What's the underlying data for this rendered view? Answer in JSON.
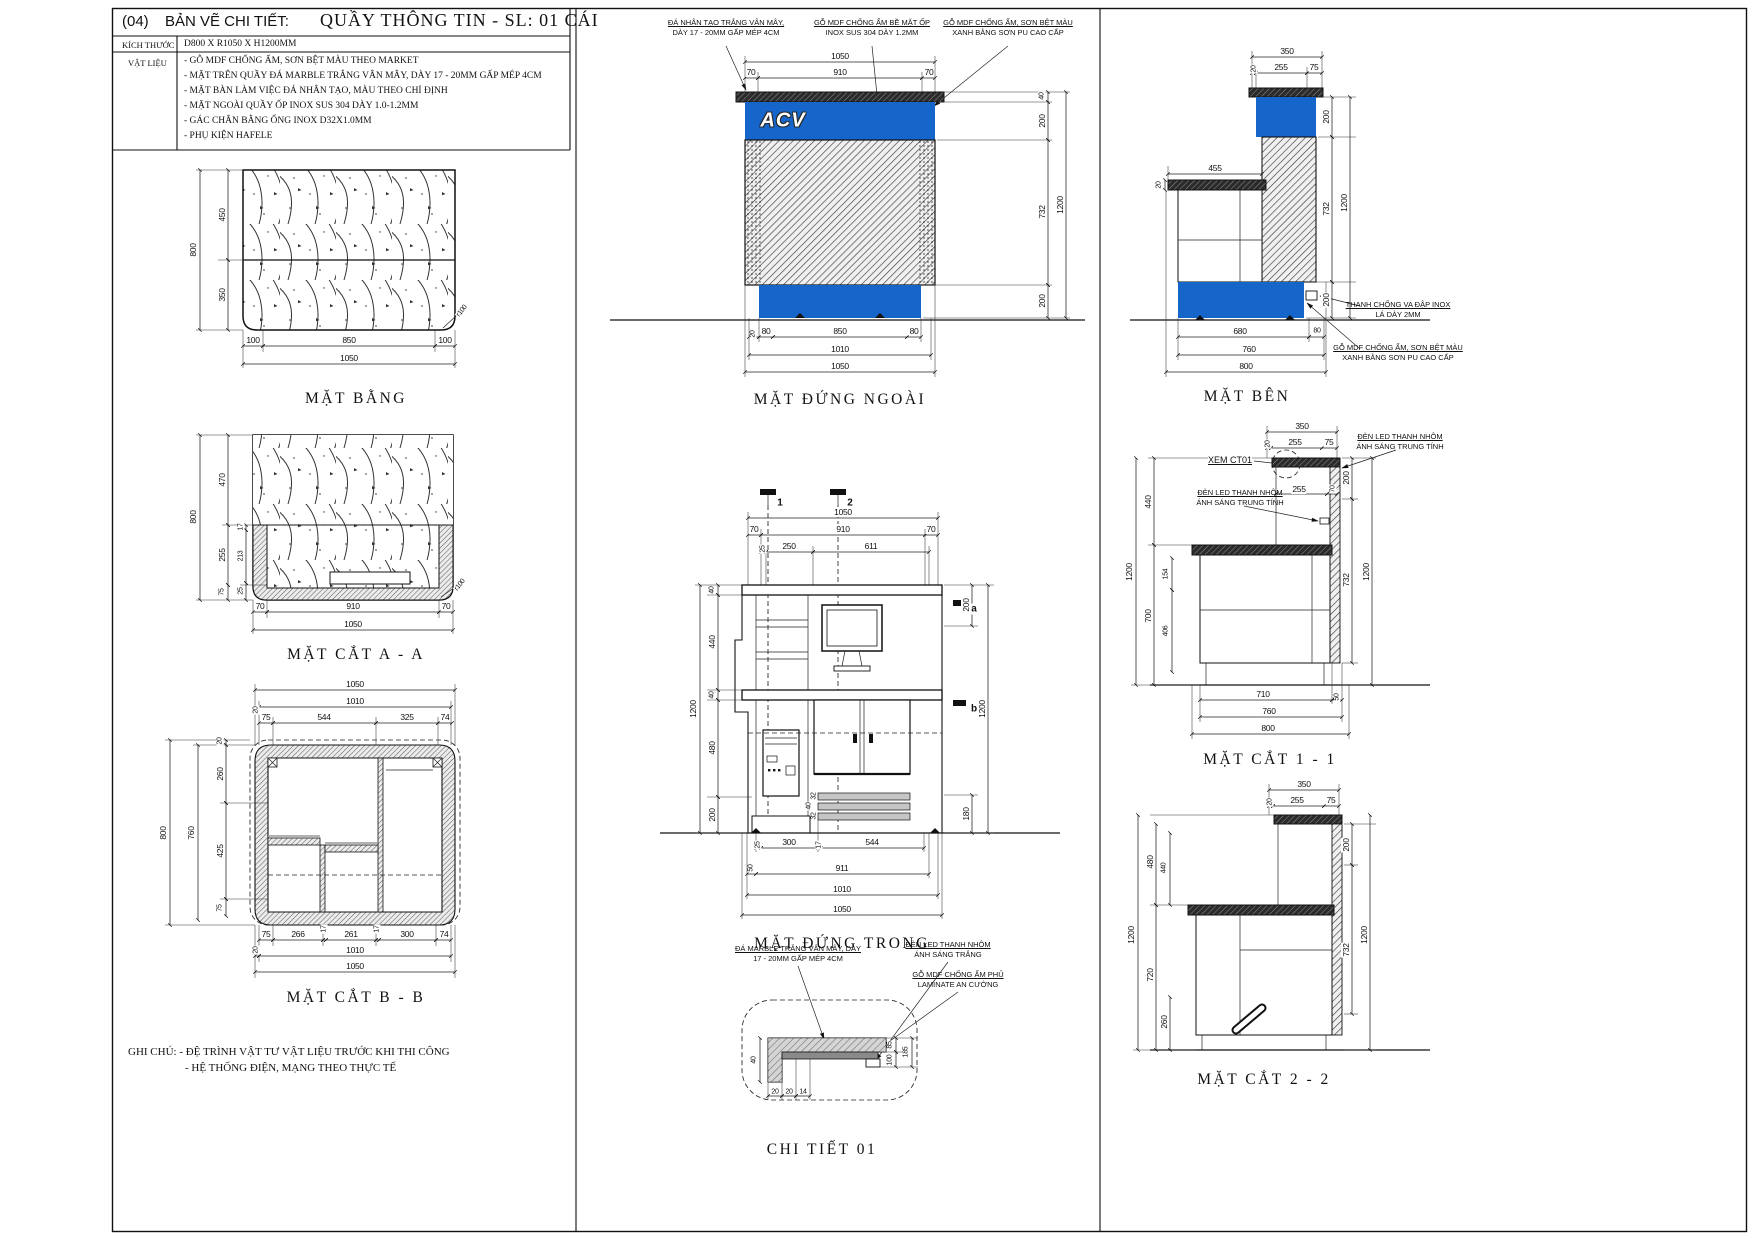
{
  "colors": {
    "accent_blue": "#1565cb",
    "line": "#111111"
  },
  "title_block": {
    "index": "(04)",
    "type_label": "BẢN VẼ CHI TIẾT:",
    "title": "QUẦY THÔNG TIN - SL: 01 CÁI",
    "size_label": "KÍCH THƯỚC",
    "size_value": "D800 X R1050 X H1200MM",
    "material_label": "VẬT LIỆU",
    "materials": [
      "- GỖ MDF CHỐNG ẨM, SƠN BỆT MÀU THEO MARKET",
      "- MẶT TRÊN QUẦY ĐÁ MARBLE TRẮNG VÂN MÂY, DÀY 17 - 20MM GẤP MÉP 4CM",
      "- MẶT BÀN LÀM VIỆC ĐÁ NHÂN TẠO, MÀU THEO CHỈ ĐỊNH",
      "- MẶT NGOÀI QUẦY ỐP INOX SUS 304 DÀY 1.0-1.2MM",
      "- GÁC CHÂN BẰNG ỐNG INOX D32X1.0MM",
      "- PHỤ KIỆN HAFELE"
    ]
  },
  "logo": {
    "text": "ACV"
  },
  "notes": {
    "line1": "GHI CHÚ: - ĐỆ TRÌNH VẬT TƯ VẬT LIỆU TRƯỚC KHI THI CÔNG",
    "line2": "- HỆ THỐNG ĐIỆN, MẠNG THEO THỰC TẾ"
  },
  "views": {
    "mat_bang": {
      "label": "MẶT BẰNG",
      "dims": {
        "w800": "800",
        "h450": "450",
        "h350": "350",
        "b100l": "100",
        "b850": "850",
        "b100r": "100",
        "b1050": "1050",
        "r": "r100"
      }
    },
    "mat_cat_aa": {
      "label": "MẶT CẮT A - A",
      "dims": {
        "l800": "800",
        "l470": "470",
        "l255": "255",
        "l75": "75",
        "i17": "17",
        "i213": "213",
        "i25": "25",
        "b70l": "70",
        "b910": "910",
        "b70r": "70",
        "b1050": "1050",
        "r": "r100"
      }
    },
    "mat_cat_bb": {
      "label": "MẶT CẮT B - B",
      "dims": {
        "t1050": "1050",
        "t1010": "1010",
        "t20": "20",
        "s75": "75",
        "s544": "544",
        "s325": "325",
        "s74": "74",
        "l800": "800",
        "l760": "760",
        "l20": "20",
        "l260": "260",
        "l425": "425",
        "l75": "75",
        "b75": "75",
        "b266": "266",
        "b17a": "17",
        "b261": "261",
        "b17b": "17",
        "b300": "300",
        "b74": "74",
        "b20": "20",
        "b1010": "1010",
        "b1050": "1050"
      }
    },
    "mat_dung_ngoai": {
      "label": "MẶT ĐỨNG NGOÀI",
      "callouts": {
        "stone1": "ĐÁ NHÂN TẠO TRẮNG VÂN MÂY,",
        "stone2": "DÀY 17 - 20MM GẤP MÉP 4CM",
        "inox1": "GỖ MDF CHỐNG ẨM BỀ MẶT ỐP",
        "inox2": "INOX SUS 304 DÀY 1.2MM",
        "mdf1": "GỖ MDF CHỐNG ẨM, SƠN BỆT MÀU",
        "mdf2": "XANH BẰNG SƠN PU CAO CẤP"
      },
      "dims": {
        "t1050": "1050",
        "t70l": "70",
        "t910": "910",
        "t70r": "70",
        "r40": "40",
        "r200t": "200",
        "r732": "732",
        "r200b": "200",
        "r1200": "1200",
        "b20": "20",
        "b80l": "80",
        "b850": "850",
        "b80r": "80",
        "b1010": "1010",
        "b1050": "1050"
      }
    },
    "mat_dung_trong": {
      "label": "MẶT ĐỨNG TRONG",
      "markers": {
        "s1": "1",
        "s2": "2",
        "a": "a",
        "b": "b"
      },
      "dims": {
        "t1050": "1050",
        "t70l": "70",
        "t910": "910",
        "t70r": "70",
        "s25": "25",
        "s250": "250",
        "s611": "611",
        "l1200": "1200",
        "l40t": "40",
        "l440": "440",
        "l40m": "40",
        "l480": "480",
        "l200": "200",
        "r200": "200",
        "r180": "180",
        "r1200": "1200",
        "f32a": "32",
        "f40": "40",
        "f32b": "32",
        "b25": "25",
        "b300": "300",
        "b17": "17",
        "b544": "544",
        "b50": "50",
        "b911": "911",
        "b1010": "1010",
        "b1050": "1050"
      }
    },
    "chi_tiet_01": {
      "label": "CHI TIẾT 01",
      "callouts": {
        "stone1": "ĐÁ MARBLE TRẮNG VÂN MÂY, DÀY",
        "stone2": "17 - 20MM GẤP MÉP 4CM",
        "led1": "ĐÈN LED THANH NHÔM",
        "led2": "ÁNH SÁNG TRẮNG",
        "mdf1": "GỖ MDF CHỐNG ẨM PHỦ",
        "mdf2": "LAMINATE AN CƯỜNG"
      },
      "dims": {
        "v40": "40",
        "b20a": "20",
        "b20b": "20",
        "b14": "14",
        "r85": "85",
        "r100": "100",
        "r185": "185"
      }
    },
    "mat_ben": {
      "label": "MẶT BÊN",
      "callouts": {
        "inox1": "THANH CHỐNG VA ĐẬP INOX",
        "inox2": "LÁ DÀY 2MM",
        "mdf1": "GỖ MDF CHỐNG ẨM, SƠN BỆT MÀU",
        "mdf2": "XANH BẰNG SƠN PU CAO CẤP"
      },
      "dims": {
        "t350": "350",
        "t20": "20",
        "t255": "255",
        "t75": "75",
        "l20": "20",
        "l455": "455",
        "r200t": "200",
        "r732": "732",
        "r200b": "200",
        "r1200": "1200",
        "b680": "680",
        "b80": "80",
        "b760": "760",
        "b800": "800"
      }
    },
    "mat_cat_11": {
      "label": "MẶT CẮT 1 - 1",
      "ref": "XEM CT01",
      "callouts": {
        "led1a": "ĐÈN LED THANH NHÔM",
        "led1b": "ÁNH SÁNG TRUNG TÍNH",
        "led2a": "ĐÈN LED THANH NHÔM",
        "led2b": "ÁNH SÁNG TRUNG TÍNH"
      },
      "dims": {
        "t350": "350",
        "t20": "20",
        "t255": "255",
        "t75": "75",
        "m255": "255",
        "m70": "70",
        "l440": "440",
        "l1200": "1200",
        "l700": "700",
        "l154": "154",
        "l406": "406",
        "r200": "200",
        "r732": "732",
        "r1200": "1200",
        "b710": "710",
        "b50": "50",
        "b760": "760",
        "b800": "800"
      }
    },
    "mat_cat_22": {
      "label": "MẶT CẮT 2 - 2",
      "dims": {
        "t350": "350",
        "t20": "20",
        "t255": "255",
        "t75": "75",
        "l480": "480",
        "l440": "440",
        "l1200": "1200",
        "l720": "720",
        "l260": "260",
        "r200": "200",
        "r732": "732",
        "r1200": "1200"
      }
    }
  }
}
